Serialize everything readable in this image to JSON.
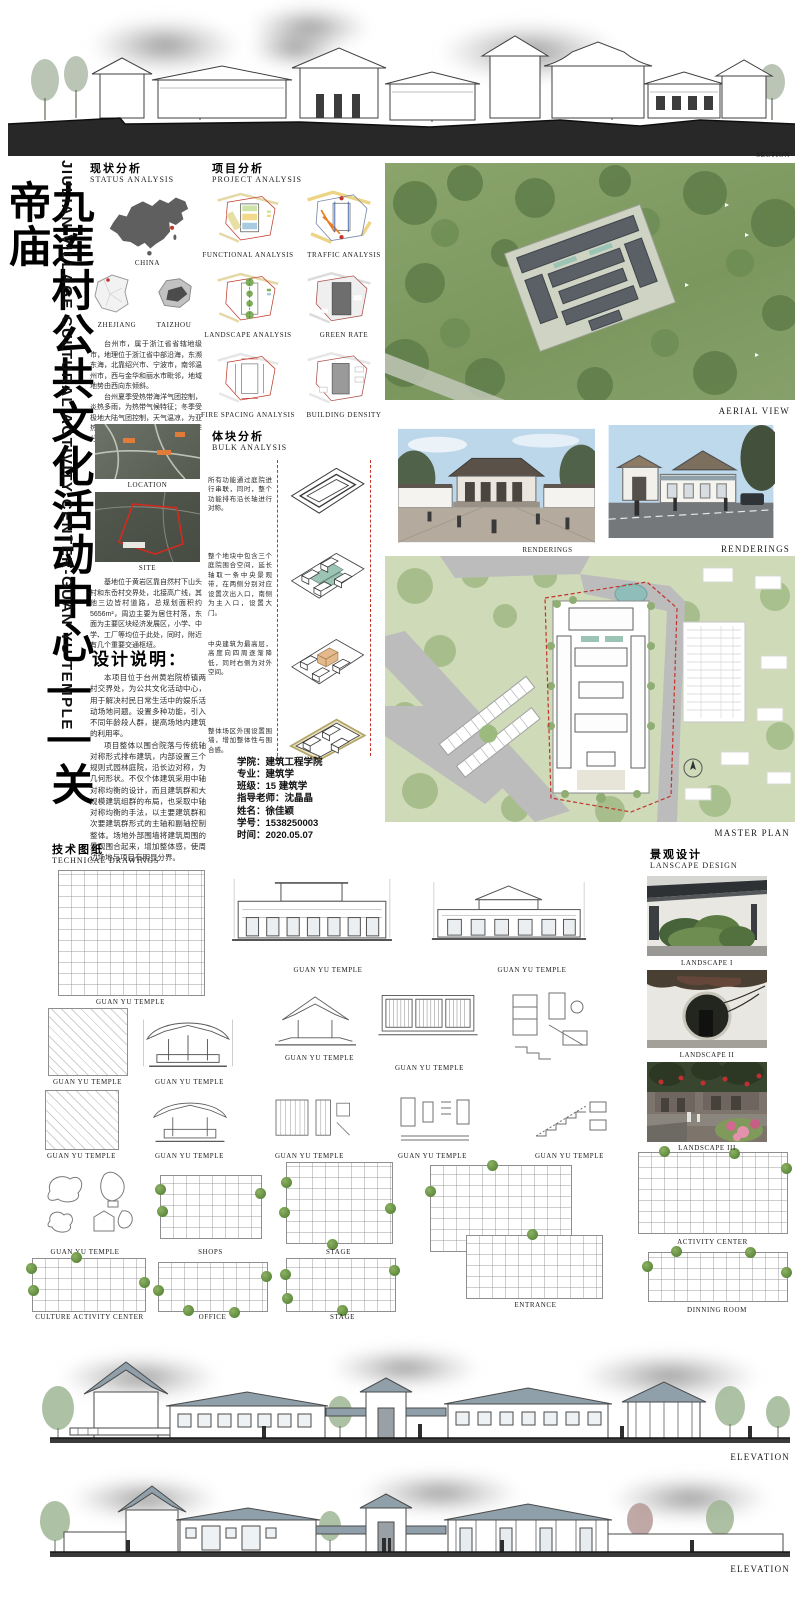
{
  "title": {
    "zh": "九莲村公共文化活动中心——关帝庙",
    "en": "JIULIAN VILLAGE CULTURAL ACTIVITY CENTER-GUAN YU TEMPLE"
  },
  "colors": {
    "accent_red": "#c2342a",
    "roof_blue": "#8fa0ab",
    "site_green": "#cfdab9",
    "ground_black": "#282828"
  },
  "top": {
    "caption": "SECTION"
  },
  "status": {
    "heading_zh": "现状分析",
    "heading_en": "STATUS ANALYSIS",
    "china": "CHINA",
    "zhejiang": "ZHEJIANG",
    "taizhou": "TAIZHOU",
    "para1a": "台州市，属于浙江省省辖地级市，地理位于浙江省中部沿海，东濒东海，北靠绍兴市、宁波市，南邻温州市，西与金华和丽水市毗邻，地域地势由西向东倾斜。",
    "para1b": "台州夏季受热带海洋气团控制，炎热多雨，为热带气候特征；冬季受极地大陆气团控制，天气温凉，为亚热带气候，总体气候温和湿润，四季分明。",
    "location": "LOCATION",
    "site": "SITE",
    "para2": "基地位于黄岩区靠自然村下山头村和东岙村交界处，北接高广线，其他三边皆村道路，总规划面积约5656m²，周边主要为居住村落，东面为主要区块经济发展区，小学、中学、工厂等均位于此处，同时，附近有几个重要交通枢纽。"
  },
  "design": {
    "heading": "设计说明：",
    "body1": "本项目位于台州黄岩院桥镇两村交界处，为公共文化活动中心，用于解决村民日常生活中的娱乐活动场地问题。设置多种功能，引入不同年龄段人群，提高场地内建筑的利用率。",
    "body2": "项目整体以围合院落与传统轴对称形式排布建筑，内部设置三个规则式园林庭院，沿长边对称，为几何形状。不仅个体建筑采用中轴对称均衡的设计，而且建筑群和大规模建筑组群的布局，也采取中轴对称均衡的手法，以主要建筑群和次要建筑群形式的主轴和副轴控制整体。场地外部围墙将建筑周围的景观围合起来，增加整体感，使周边场地与项目有明显分界。"
  },
  "project": {
    "heading_zh": "项目分析",
    "heading_en": "PROJECT ANALYSIS",
    "captions": [
      "FUNCTIONAL ANALYSIS",
      "TRAFFIC ANALYSIS",
      "LANDSCAPE ANALYSIS",
      "GREEN RATE",
      "FIRE SPACING ANALYSIS",
      "BUILDING DENSITY"
    ]
  },
  "bulk": {
    "heading_zh": "体块分析",
    "heading_en": "BULK ANALYSIS",
    "notes": [
      "所有功能通过庭院进行串联，同时，整个功能排布沿长轴进行对称。",
      "整个地块中包含三个庭院围合空间，延长轴取一条中央景观带，在两侧分别对应设置次出入口，南侧为主入口，设置大门。",
      "中央建筑为最高层，高度向四周逐渐降低，同时右侧为对外空间。",
      "整体场区外围设置围墙，增加整体性与围合感。"
    ]
  },
  "info": {
    "lines": [
      "学院：建筑工程学院",
      "专业：建筑学",
      "班级：15 建筑学",
      "指导老师：沈晶晶",
      "姓名：徐佳颖",
      "学号：1538250003",
      "时间：2020.05.07"
    ]
  },
  "views": {
    "aerial": "AERIAL VIEW",
    "rendering_left": "RENDERINGS",
    "rendering_right": "RENDERINGS",
    "master": "MASTER PLAN"
  },
  "tech": {
    "heading_zh": "技术图纸",
    "heading_en": "TECHNICAL DRAWINGS",
    "rowA": [
      "GUAN YU TEMPLE",
      "GUAN YU TEMPLE",
      "GUAN YU TEMPLE"
    ],
    "rowB": [
      "GUAN YU TEMPLE",
      "GUAN YU TEMPLE",
      "GUAN YU TEMPLE",
      "GUAN YU TEMPLE"
    ],
    "rowC": [
      "GUAN YU TEMPLE",
      "GUAN YU TEMPLE",
      "GUAN YU TEMPLE",
      "GUAN YU TEMPLE",
      "GUAN YU TEMPLE"
    ],
    "rowD": [
      "GUAN YU TEMPLE",
      "SHOPS",
      "STAGE",
      "ACTIVITY CENTER"
    ],
    "rowE": [
      "CULTURE ACTIVITY CENTER",
      "OFFICE",
      "STAGE",
      "ENTRANCE",
      "DINNING ROOM"
    ]
  },
  "landscape": {
    "heading_zh": "景观设计",
    "heading_en": "LANSCAPE DESIGN",
    "captions": [
      "LANDSCAPE I",
      "LANDSCAPE II",
      "LANDSCAPE III"
    ]
  },
  "elevation": {
    "captions": [
      "ELEVATION",
      "ELEVATION"
    ]
  }
}
